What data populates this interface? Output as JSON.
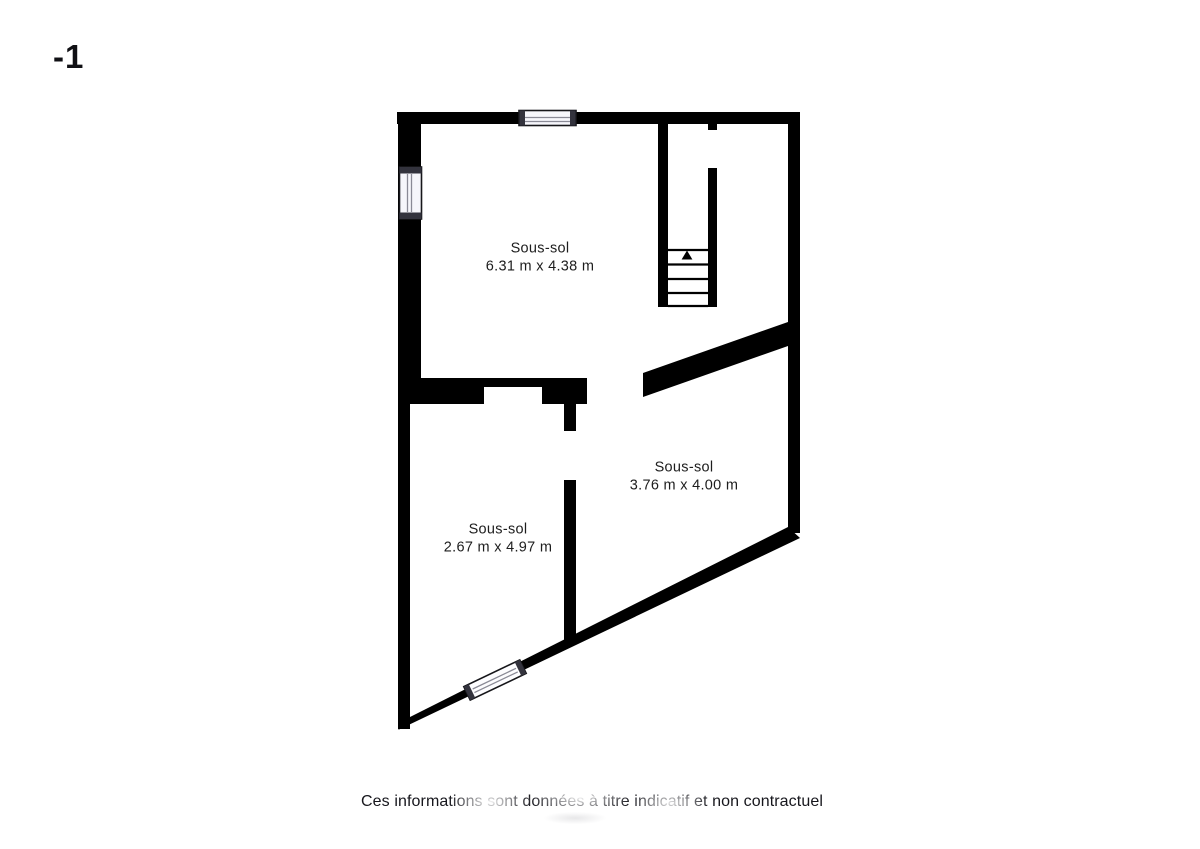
{
  "floor_label": "-1",
  "plan": {
    "rooms": [
      {
        "name": "Sous-sol",
        "dimensions": "6.31 m x 4.38 m"
      },
      {
        "name": "Sous-sol",
        "dimensions": "3.76 m x 4.00 m"
      },
      {
        "name": "Sous-sol",
        "dimensions": "2.67 m x 4.97 m"
      }
    ],
    "stairs": {
      "direction_arrow": "up",
      "treads": 5
    },
    "windows": [
      "top-wall-window",
      "left-wall-window",
      "bottom-diagonal-wall-window"
    ],
    "disclaimer": "Ces informations sont données à titre indicatif et non contractuel"
  },
  "colors": {
    "background": "#ffffff",
    "wall": "#000000",
    "window_fill": "#f6f6fb",
    "window_frame": "#16161a",
    "window_cap": "#33333d",
    "window_mullion": "#8a8a96",
    "text": "#1d1d1d"
  }
}
